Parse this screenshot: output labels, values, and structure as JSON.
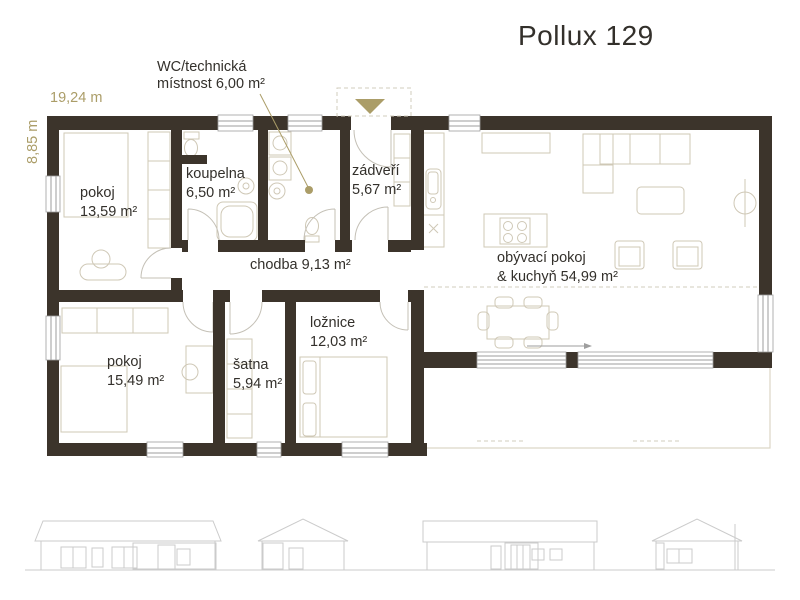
{
  "title": "Pollux 129",
  "annotation": {
    "line1": "WC/technická",
    "line2": "místnost 6,00 m²"
  },
  "dimensions": {
    "width": "19,24 m",
    "height": "8,85 m"
  },
  "rooms": {
    "pokoj1": {
      "line1": "pokoj",
      "line2": "13,59 m²"
    },
    "koupelna": {
      "line1": "koupelna",
      "line2": "6,50 m²"
    },
    "zadveri": {
      "line1": "zádveří",
      "line2": "5,67 m²"
    },
    "chodba": {
      "line1": "chodba 9,13 m²"
    },
    "obyvaci": {
      "line1": "obývací pokoj",
      "line2": "& kuchyň 54,99 m²"
    },
    "pokoj2": {
      "line1": "pokoj",
      "line2": "15,49 m²"
    },
    "satna": {
      "line1": "šatna",
      "line2": "5,94 m²"
    },
    "loznice": {
      "line1": "ložnice",
      "line2": "12,03 m²"
    }
  },
  "icons": {
    "entrance_marker": "downward-triangle"
  },
  "colors": {
    "wall": "#3c342b",
    "accent": "#ab9d68",
    "furn": "#cfc8b6",
    "arc": "#c4c0b6",
    "win": "#9e9e9e",
    "elev": "#cbcbcb",
    "terrace": "#dcd6c6",
    "text": "#33302b"
  }
}
